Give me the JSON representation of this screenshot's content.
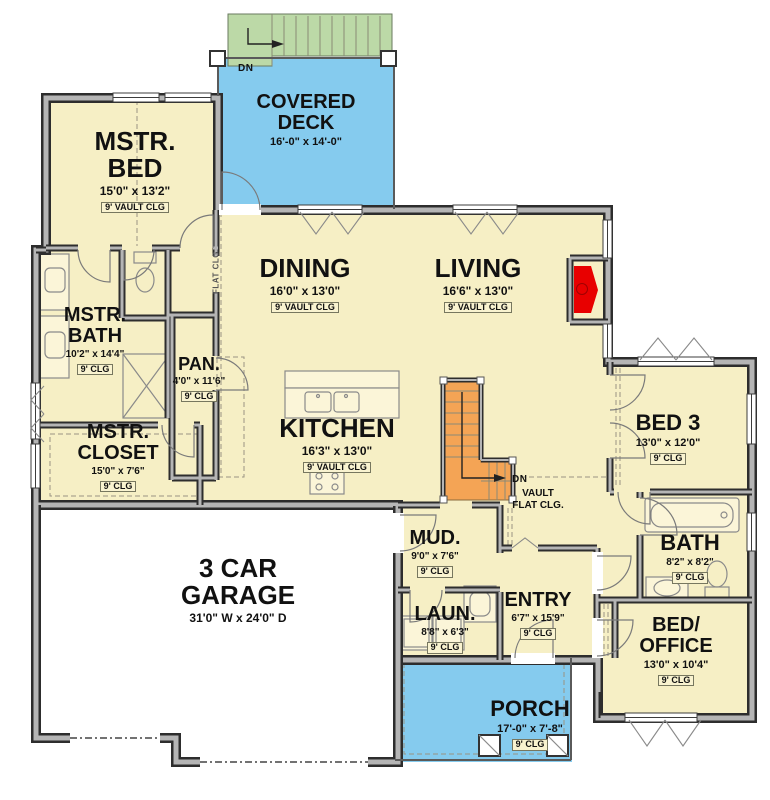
{
  "meta": {
    "title": "First Floor Plan"
  },
  "colors": {
    "floor": "#f6efc5",
    "deck": "#85cbee",
    "porch": "#85cbee",
    "stairs_exterior": "#bcd9a7",
    "stairs_interior": "#f4a455",
    "garage": "#ffffff",
    "wall_edge": "#2d2d2d",
    "wall_core": "#b5b5b5",
    "fireplace": "#e80000"
  },
  "rooms": {
    "covered_deck": {
      "name": "COVERED DECK",
      "dims": "16'-0\" x 14'-0\""
    },
    "mstr_bed": {
      "name": "MSTR. BED",
      "dims": "15'0\" x 13'2\"",
      "clg": "9' VAULT CLG"
    },
    "dining": {
      "name": "DINING",
      "dims": "16'0\" x 13'0\"",
      "clg": "9' VAULT CLG"
    },
    "living": {
      "name": "LIVING",
      "dims": "16'6\" x 13'0\"",
      "clg": "9' VAULT CLG"
    },
    "mstr_bath": {
      "name": "MSTR. BATH",
      "dims": "10'2\" x 14'4\"",
      "clg": "9' CLG"
    },
    "pan": {
      "name": "PAN.",
      "dims": "4'0\" x 11'6\"",
      "clg": "9' CLG"
    },
    "mstr_closet": {
      "name": "MSTR. CLOSET",
      "dims": "15'0\" x 7'6\"",
      "clg": "9' CLG"
    },
    "kitchen": {
      "name": "KITCHEN",
      "dims": "16'3\" x 13'0\"",
      "clg": "9' VAULT CLG"
    },
    "bed3": {
      "name": "BED 3",
      "dims": "13'0\" x 12'0\"",
      "clg": "9' CLG"
    },
    "garage": {
      "name": "3 CAR GARAGE",
      "dims": "31'0\" W x 24'0\" D"
    },
    "mud": {
      "name": "MUD.",
      "dims": "9'0\" x 7'6\"",
      "clg": "9' CLG"
    },
    "laun": {
      "name": "LAUN.",
      "dims": "8'8\" x 6'3\"",
      "clg": "9' CLG"
    },
    "entry": {
      "name": "ENTRY",
      "dims": "6'7\" x 15'9\"",
      "clg": "9' CLG"
    },
    "bath": {
      "name": "BATH",
      "dims": "8'2\" x 8'2\"",
      "clg": "9' CLG"
    },
    "bed_office": {
      "name": "BED/ OFFICE",
      "dims": "13'0\" x 10'4\"",
      "clg": "9' CLG"
    },
    "porch": {
      "name": "PORCH",
      "dims": "17'-0\" x 7'-8\"",
      "clg": "9' CLG"
    }
  },
  "annotations": {
    "deck_dn": "DN",
    "stair_dn": "DN",
    "stair_vault": "VAULT",
    "stair_flat": "FLAT CLG.",
    "flat_clg_vertical": "FLAT CLG"
  }
}
